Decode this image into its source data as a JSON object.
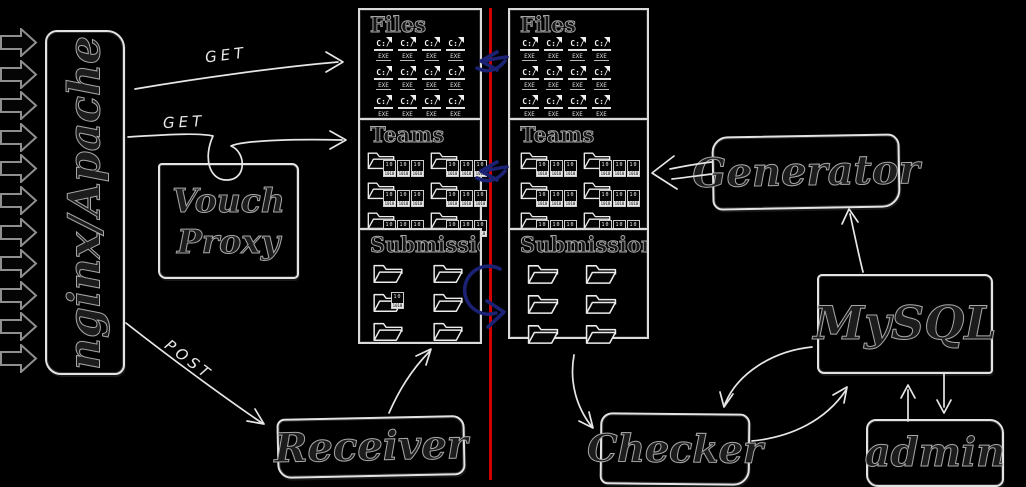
{
  "colors": {
    "background": "#000000",
    "sketch_stroke": "#e3e3e3",
    "ink": "#1c1c1c",
    "divider_red": "#d10000",
    "arrow_blue": "#1b2173",
    "incoming_gray": "#8f8f8f",
    "arrow_white": "#e6e6e6"
  },
  "labels": {
    "get_top": "GET",
    "get_mid": "GET",
    "post": "POST"
  },
  "nodes": {
    "nginx": {
      "label": "nginx/Apache"
    },
    "vouch": {
      "label": "Vouch Proxy"
    },
    "generator": {
      "label": "Generator"
    },
    "mysql": {
      "label": "MySQL"
    },
    "admin": {
      "label": "admin"
    },
    "checker": {
      "label": "Checker"
    },
    "receiver": {
      "label": "Receiver"
    }
  },
  "storage": {
    "left": {
      "files": {
        "label": "Files",
        "count": 12
      },
      "teams": {
        "label": "Teams",
        "count": 6
      },
      "submissions": {
        "label": "Submissio",
        "count": 6,
        "has_extra_binary_file": true
      }
    },
    "right": {
      "files": {
        "label": "Files",
        "count": 12
      },
      "teams": {
        "label": "Teams",
        "count": 6
      },
      "submissions": {
        "label": "Submissions",
        "count": 6
      }
    }
  },
  "icons": {
    "exe_file": {
      "name": "exe-file-icon",
      "line1": "C:/",
      "line2": "EXE"
    },
    "binary_file": {
      "name": "binary-file-icon",
      "bits": "10",
      "band": "1010"
    },
    "folder": {
      "name": "folder-icon"
    }
  },
  "incoming_requests": {
    "count": 11
  }
}
